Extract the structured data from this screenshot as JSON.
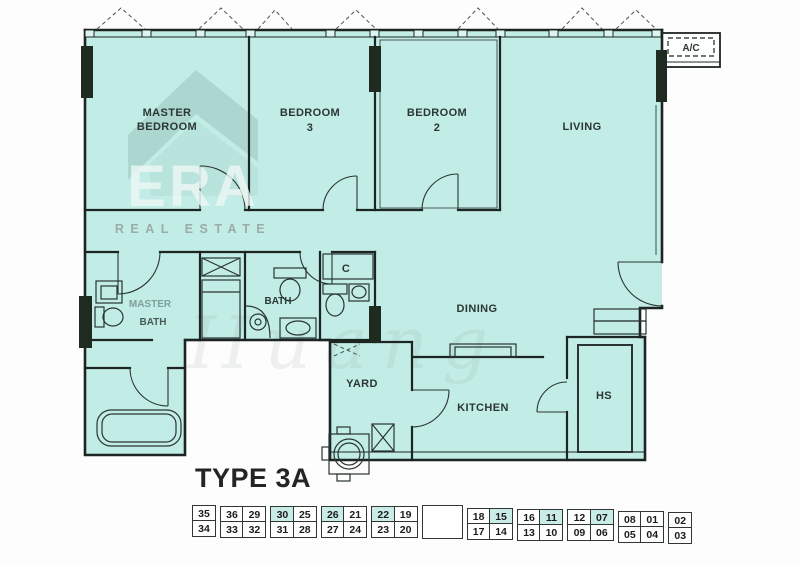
{
  "title": "TYPE 3A",
  "logo": {
    "era": "ERA",
    "tagline": "REAL ESTATE"
  },
  "watermark_text": "Huang",
  "rooms": {
    "aircon_ledge": "A/C",
    "master_bedroom": [
      "MASTER",
      "BEDROOM"
    ],
    "bedroom_3": [
      "BEDROOM",
      "3"
    ],
    "bedroom_2": [
      "BEDROOM",
      "2"
    ],
    "living": "LIVING",
    "master_bath": [
      "MASTER",
      "BATH"
    ],
    "bath": "BATH",
    "closet": "C",
    "dining": "DINING",
    "yard": "YARD",
    "kitchen": "KITCHEN",
    "household_shelter": "HS"
  },
  "unit_grid": {
    "highlight_color": "#c9ece8",
    "blocks": [
      {
        "columns": [
          {
            "top": "35",
            "bottom": "34"
          }
        ]
      },
      {
        "columns": [
          {
            "top": "36",
            "bottom": "33"
          },
          {
            "top": "29",
            "bottom": "32"
          }
        ]
      },
      {
        "columns": [
          {
            "top": "30",
            "bottom": "31",
            "top_highlight": true
          },
          {
            "top": "25",
            "bottom": "28"
          }
        ]
      },
      {
        "columns": [
          {
            "top": "26",
            "bottom": "27",
            "top_highlight": true
          },
          {
            "top": "21",
            "bottom": "24"
          }
        ]
      },
      {
        "columns": [
          {
            "top": "22",
            "bottom": "23",
            "top_highlight": true
          },
          {
            "top": "19",
            "bottom": "20"
          }
        ]
      },
      {
        "gap": true
      },
      {
        "columns": [
          {
            "top": "18",
            "bottom": "17"
          },
          {
            "top": "15",
            "bottom": "14",
            "top_highlight": true
          }
        ]
      },
      {
        "columns": [
          {
            "top": "16",
            "bottom": "13"
          },
          {
            "top": "11",
            "bottom": "10",
            "top_highlight": true
          }
        ]
      },
      {
        "columns": [
          {
            "top": "12",
            "bottom": "09"
          },
          {
            "top": "07",
            "bottom": "06",
            "top_highlight": true
          }
        ]
      },
      {
        "columns": [
          {
            "top": "08",
            "bottom": "05"
          },
          {
            "top": "01",
            "bottom": "04"
          }
        ]
      },
      {
        "columns": [
          {
            "top": "02",
            "bottom": "03"
          }
        ]
      }
    ]
  },
  "colors": {
    "plan_fill": "#c1ede6",
    "wall_line": "#1d2523",
    "structural_column": "#1f2b20",
    "cell_highlight": "#c9ece8",
    "background": "#fcfdfc"
  }
}
